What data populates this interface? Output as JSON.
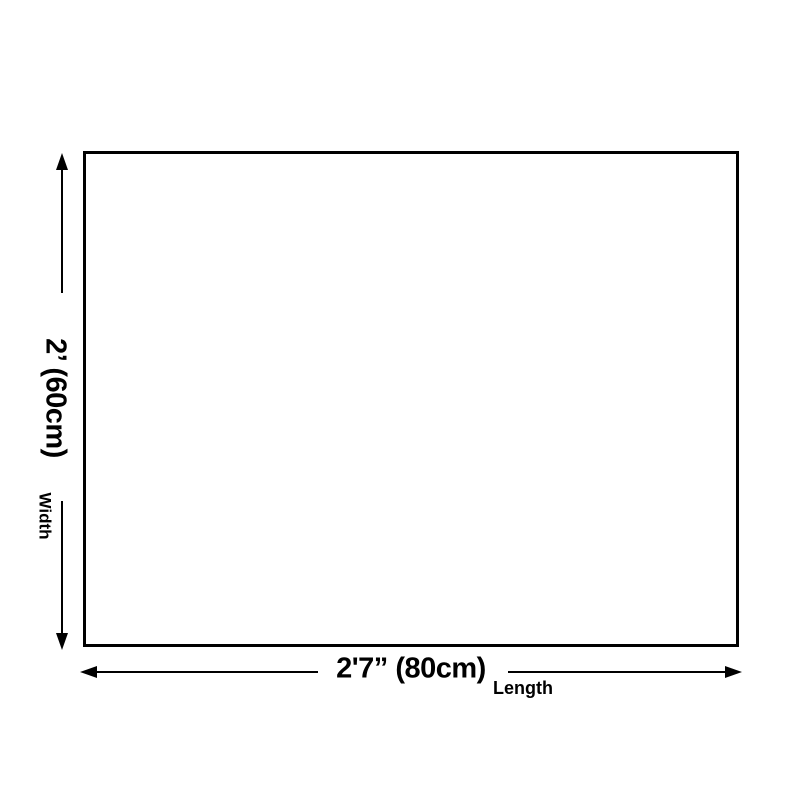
{
  "diagram": {
    "type": "product-size-diagram",
    "colors": {
      "background": "#ffffff",
      "line": "#000000",
      "rect_fill": "#ffffff"
    },
    "dimensions": {
      "width": {
        "value": "2’ (60cm)",
        "axis_label": "Width"
      },
      "length": {
        "value": "2'7” (80cm)",
        "axis_label": "Length"
      }
    }
  }
}
